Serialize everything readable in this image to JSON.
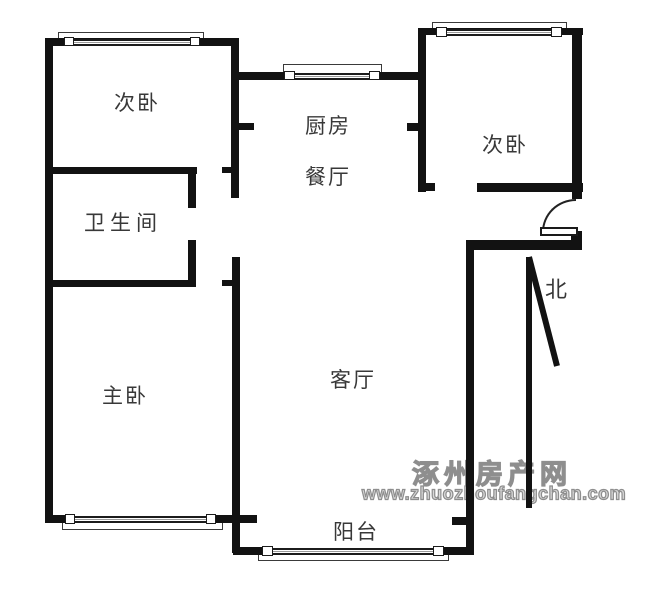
{
  "floorplan": {
    "wall_color": "#121212",
    "background_color": "#ffffff",
    "label_color": "#383838",
    "rooms": [
      {
        "id": "bedroom-left",
        "label": "次卧"
      },
      {
        "id": "bathroom",
        "label": "卫生间"
      },
      {
        "id": "master-bedroom",
        "label": "主卧"
      },
      {
        "id": "kitchen",
        "label": "厨房"
      },
      {
        "id": "dining",
        "label": "餐厅"
      },
      {
        "id": "bedroom-right",
        "label": "次卧"
      },
      {
        "id": "living-room",
        "label": "客厅"
      },
      {
        "id": "balcony",
        "label": "阳台"
      }
    ],
    "compass": {
      "label": "北"
    }
  },
  "watermark": {
    "line1": "涿州房产网",
    "line2": "www.zhuozhoufangchan.com",
    "text_color": "#d9d9d9",
    "outline_color": "#8e8e8e"
  }
}
